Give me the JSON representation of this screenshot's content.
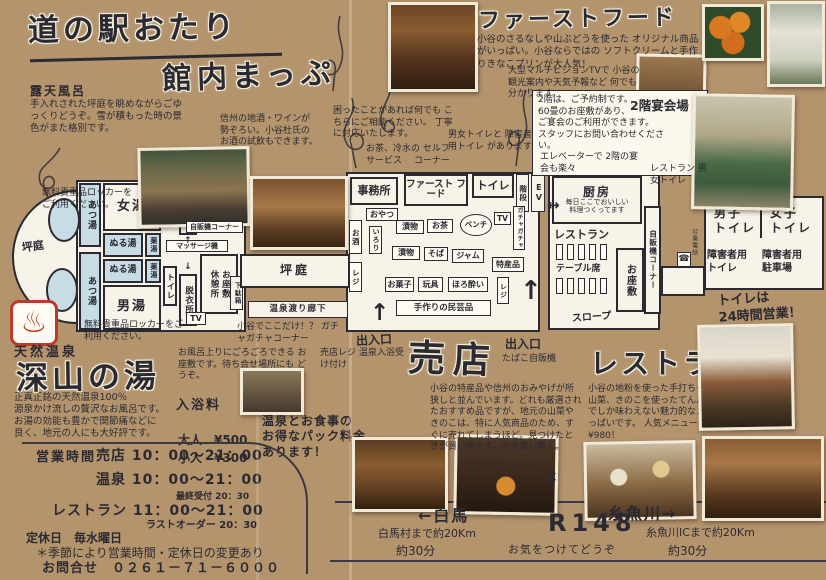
{
  "header": {
    "title1": "道の駅おたり",
    "title2": "館内まっぷ"
  },
  "left": {
    "rotenburo_title": "露天風呂",
    "rotenburo_desc": "手入れされた坪庭を眺めながらごゆっくりどうぞ。雪が積もった時の景色がまた格別です。",
    "locker_note": "無料貴重品ロッカーをご利用ください。",
    "spa_icon": "♨"
  },
  "onsen": {
    "label": "天然温泉",
    "title": "深山の湯",
    "desc": "正真正銘の天然温泉100％\n源泉かけ流しの贅沢なお風呂です。\nお湯の効能も豊かで関節痛などに\n良く、地元の人にも大好評です。",
    "fees_label": "入浴料",
    "fee_adult_label": "大人",
    "fee_adult": "¥500",
    "fee_child_label": "小人",
    "fee_child": "¥300",
    "pack_note": "温泉とお食事の\nお得なパック料金\nあります！"
  },
  "topnotes": {
    "fastfood_title": "ファーストフード",
    "fastfood_desc": "小谷のさるなしや山ぶどうを使った\nオリジナル商品がいっぱい。小谷ならではの\nソフトクリームと手作りきなこプリンが大人気！",
    "tv_note": "大型マルチビジョンTVで\n小谷の観光案内や天気予報など\n何でも分かります。",
    "banquet_label": "2階宴会場",
    "banquet_note": "2階は、ご予約制です。\n60畳のお座敷があり、\nご宴会のご利用ができます。\nスタッフにお問い合わせください。",
    "elevator_note": "エレベーターで\n2階の宴会も楽々",
    "resto_wc_note": "レストラン\n男女トイレ",
    "office_note": "困ったことがあれば何でも\nこちらにご相談ください。\n丁寧に対応いたします。",
    "sake_note": "信州の地酒・ワインが\n勢ぞろい。小谷杜氏の\nお酒の試飲もできます。",
    "self_note": "お茶、冷水の\nセルフサービス\n　コーナー",
    "wc_note": "男女トイレと\n障害者用トイレ\nがあります"
  },
  "plannotes": {
    "gacha": "小谷でここだけ！？\nガチャガチャコーナー",
    "zashiki": "お風呂上りにごろごろできる\nお座敷です。待ち合せ場所にも\nどうぞ。",
    "register": "売店レジ\n温泉入浴受け付け",
    "tabako": "たばこ自販機",
    "toilet24": "トイレは\n24時間営業！"
  },
  "rooms": {
    "tsuboniwa": "坪庭",
    "atsuyu": "あつ湯",
    "onnayu": "女湯",
    "otokoyu": "男湯",
    "nuruyu": "ぬる湯",
    "kusuriyu": "薬湯",
    "toilet": "トイレ",
    "datsuijo": "脱衣所",
    "boiler": "ボイラー室",
    "boiler_sub": "（立入禁止）",
    "jihanki": "自販機コーナー",
    "massage": "マッサージ機",
    "ozashiki": "お座敷",
    "kyukeijo": "休憩所",
    "tv": "TV",
    "getabako": "下駄箱",
    "corridor": "温泉渡り廊下",
    "jimusho": "事務所",
    "fastfood": "ファースト\nフード",
    "kaidan": "階段",
    "ev": "EV",
    "oyatsu": "おやつ",
    "irori": "いろり",
    "osake": "お酒",
    "reji": "レジ",
    "tsukemono": "漬物",
    "ocha": "お茶",
    "bench": "ベンチ",
    "gacha": "ガチャガチャ",
    "soba": "そば",
    "jam": "ジャム",
    "tokusan": "特産品",
    "okashi": "お菓子",
    "gangu": "玩具",
    "horoyoi": "ほろ酔い",
    "mingei": "手作りの民芸品",
    "deiriguchi": "出入口",
    "chubo": "厨房",
    "chubo_note": "毎日ここでおいしい\n料理つくってます",
    "resto": "レストラン",
    "table": "テーブル席",
    "slope": "スロープ",
    "koshudenwa": "公衆電話",
    "phone_icon": "☎",
    "danshi": "男子\nトイレ",
    "joshi": "女子\nトイレ",
    "shogai_wc": "障害者用\nトイレ",
    "shogai_p": "障害者用\n駐車場"
  },
  "shop": {
    "title": "売店",
    "desc": "小谷の特産品や信州のおみやげが所狭しと並んでいます。どれも厳選されたおすすめ品ですが、地元の山菜やきのこは、特に人気商品のため、すぐに売れてしまうほど。見つけたときが買い時です。お見逃し無く。"
  },
  "restaurant": {
    "title": "レストラン",
    "desc": "小谷の地粉を使った手打ちそばや\n地元の山菜、きのこを使ったてんぷらなど\nここでしか味わえない魅力的なメニューが\nいっぱいです。\n人気メニューは、小谷定食¥980！"
  },
  "hours": {
    "label": "営業時間",
    "shop": "売店 10：00～21：00",
    "onsen": "温泉 10：00～21：00",
    "onsen_last": "最終受付 20：30",
    "resto": "レストラン 11：00～21：00",
    "resto_last": "ラストオーダー 20：30",
    "closed": "定休日　毎水曜日",
    "season_note": "＊季節により営業時間・定休日の変更あり",
    "contact": "お問合せ　０２６１－７１－６０００"
  },
  "road": {
    "hakuba": "←白馬",
    "hakuba_km": "白馬村まで約20Km",
    "hakuba_min": "約30分",
    "route": "R148",
    "care": "お気をつけてどうぞ",
    "itoigawa": "糸魚川→",
    "itoigawa_km": "糸魚川ICまで約20Km",
    "itoigawa_min": "約30分",
    "updown": "↕"
  },
  "arrows": {
    "up": "↑",
    "down": "↓",
    "lr": "↔"
  },
  "colors": {
    "paper": "#b3946d",
    "ink": "#2b2a31",
    "bath_blue": "#c7dce4",
    "accent_red": "#c03a2a",
    "plan_white": "#f7f3e8"
  }
}
